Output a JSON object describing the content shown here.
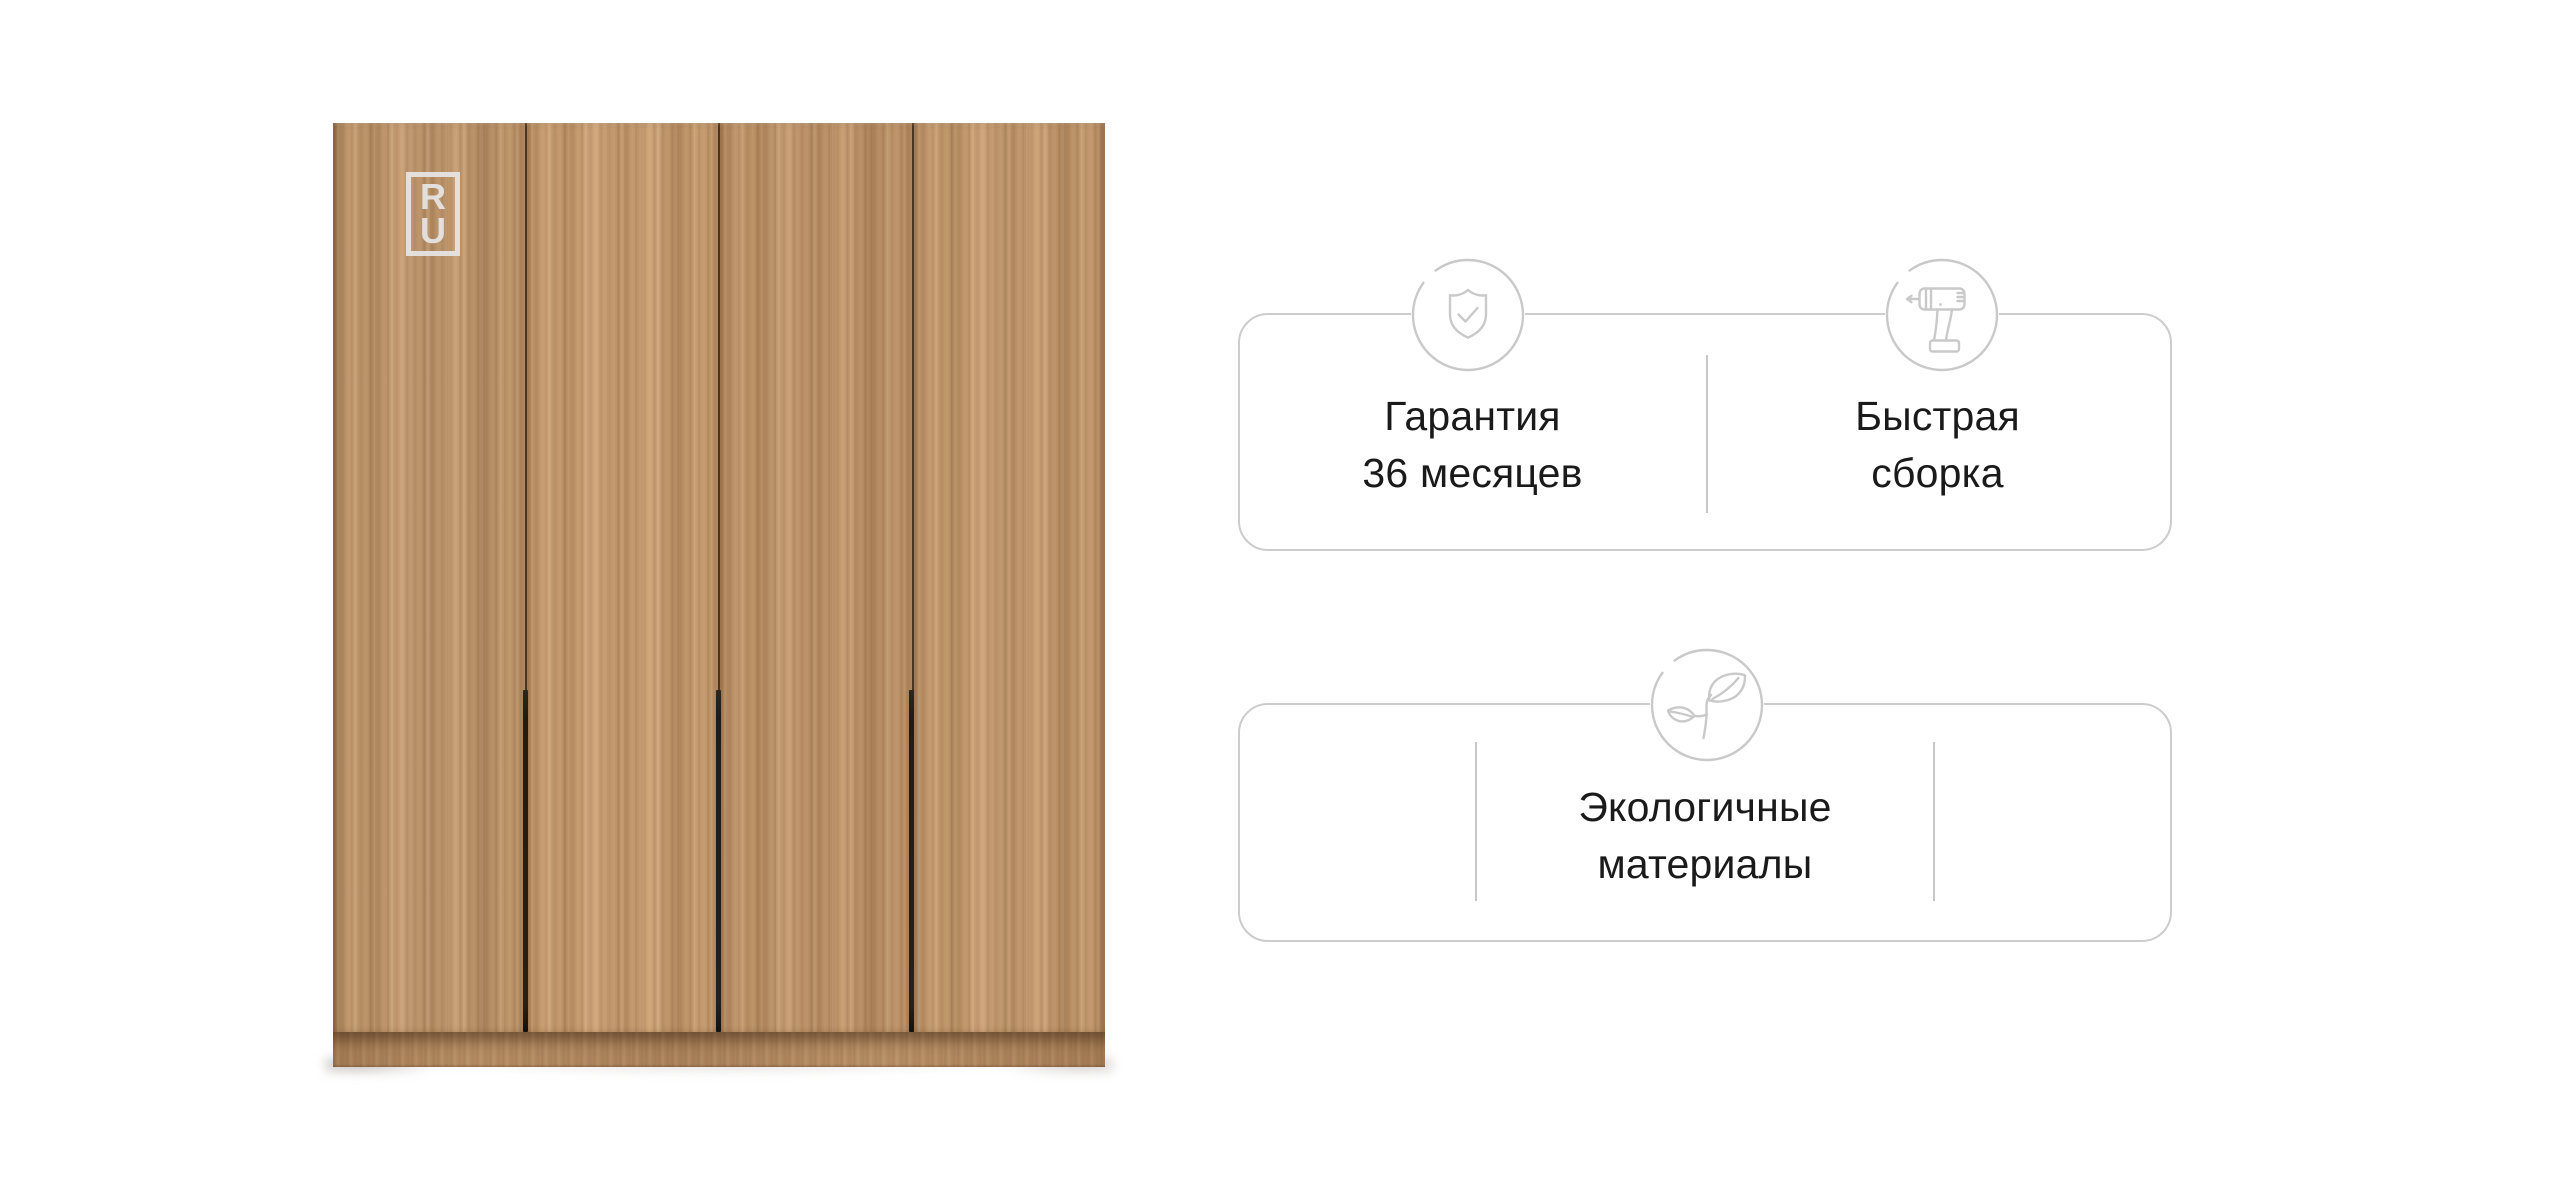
{
  "brand": {
    "logo_letters": [
      "R",
      "U"
    ]
  },
  "features": {
    "cards": [
      {
        "items": [
          {
            "icon": "shield-check-icon",
            "lines": [
              "Гарантия",
              "36 месяцев"
            ]
          },
          {
            "icon": "drill-icon",
            "lines": [
              "Быстрая",
              "сборка"
            ]
          }
        ]
      },
      {
        "items": [
          {
            "icon": "plant-icon",
            "lines": [
              "Экологичные",
              "материалы"
            ]
          }
        ]
      }
    ]
  },
  "colors": {
    "card_border": "#cccccc",
    "divider": "#c7c7c7",
    "icon_stroke": "#c9c9c9",
    "text": "#1a1a1a",
    "wood_base": "#b78e65",
    "handle": "#24201b"
  }
}
